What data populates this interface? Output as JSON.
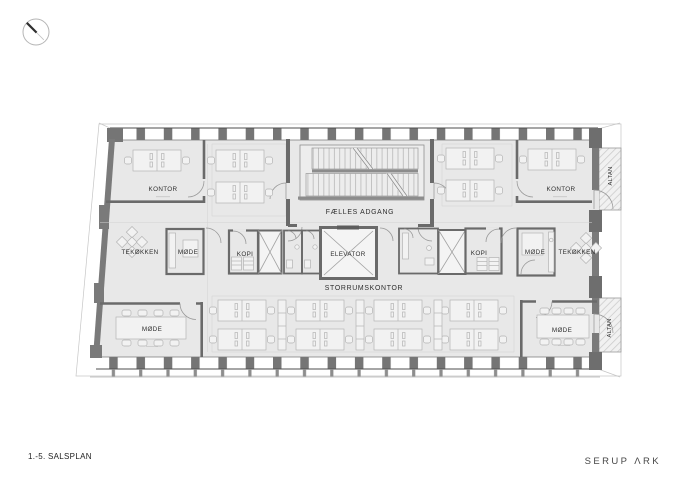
{
  "drawing": {
    "title": "1.-5. SALSPLAN",
    "firm": "SERUP ΛRK",
    "labels": {
      "kontor_left": "KONTOR",
      "kontor_right": "KONTOR",
      "faelles_adgang": "FÆLLES ADGANG",
      "elevator": "ELEVATOR",
      "kopi_left": "KOPI",
      "kopi_right": "KOPI",
      "mode_core_left": "MØDE",
      "mode_core_right": "MØDE",
      "tekokken_left": "TEKØKKEN",
      "tekokken_right": "TEKØKKEN",
      "storrumskontor": "STORRUMSKONTOR",
      "mode_bottom_left": "MØDE",
      "mode_bottom_right": "MØDE",
      "altan_top": "ALTAN",
      "altan_bottom": "ALTAN"
    },
    "colors": {
      "floor": "#e8e8e8",
      "wall": "#757575",
      "wall_dark": "#4e4e4e",
      "furniture": "#b4b4b4",
      "stair_tread": "#a6a6a6",
      "balcony_hatch": "#cccccc",
      "label_text": "#2e2e2e"
    }
  }
}
